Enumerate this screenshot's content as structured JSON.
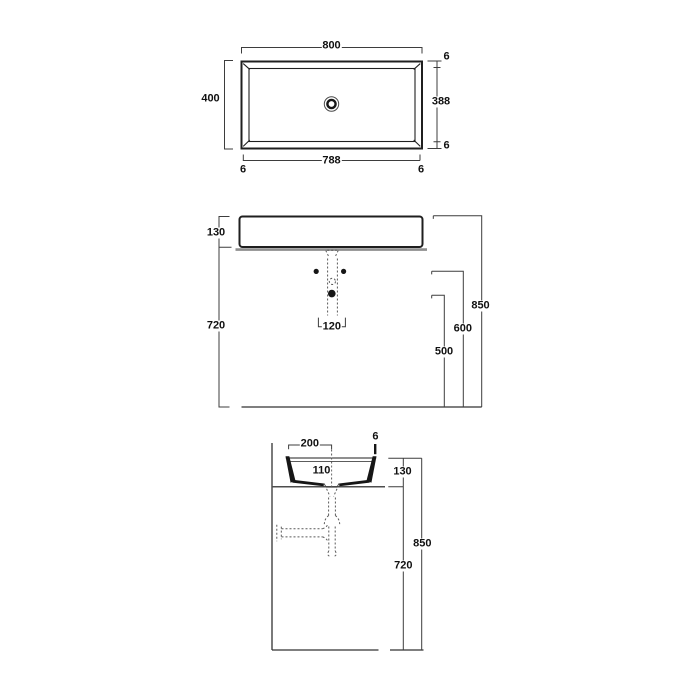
{
  "colors": {
    "line": "#1f1f1f",
    "dim": "#3d3d3d",
    "counter": "#8e8e8e",
    "plumbing_dash": "#5a5a5a",
    "background": "#ffffff"
  },
  "views": {
    "top": {
      "dims": {
        "overall_width": "800",
        "overall_depth": "400",
        "rim_top": "6",
        "inner_depth": "388",
        "rim_bottom": "6",
        "inner_width": "788",
        "rim_left": "6",
        "rim_right": "6"
      }
    },
    "front": {
      "dims": {
        "basin_height": "130",
        "counter_height": "720",
        "tap_spacing": "120",
        "overall_height": "850",
        "fixing_height": "600",
        "drain_height": "500"
      }
    },
    "side": {
      "dims": {
        "drain_offset": "200",
        "rim_thickness": "6",
        "tap_offset": "110",
        "basin_height": "130",
        "overall_height": "850",
        "counter_height": "720"
      }
    }
  }
}
